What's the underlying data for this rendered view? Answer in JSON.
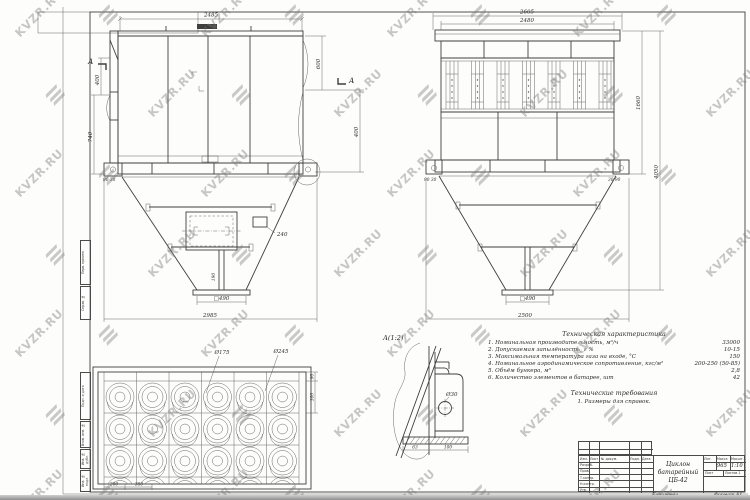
{
  "watermark": {
    "text": "KVZR.RU"
  },
  "front_view": {
    "section_label": "А",
    "dims": {
      "top_width": "2485",
      "left_upper": "400",
      "left_lower": "740",
      "right_upper": "600",
      "right_outer": "400",
      "foot_left": "90 30",
      "hatch_leader": "240",
      "center_post": "190",
      "outlet": "□490",
      "bottom_width": "2985"
    }
  },
  "side_view": {
    "dims": {
      "top_outer": "2605",
      "top_inner": "2480",
      "right_body": "1660",
      "right_total": "4050",
      "foot_left": "90 30",
      "foot_right": "30 90",
      "outlet": "□490",
      "bottom_width": "2500"
    }
  },
  "plan_view": {
    "dims": {
      "inner_dia": "Ø175",
      "outer_dia": "Ø245",
      "pitch_a": "200",
      "pitch_b": "380",
      "right_a": "90",
      "right_b": "300"
    }
  },
  "detail_view": {
    "label": "А(1:2)",
    "hole_dia": "Ø30",
    "dim_a": "63",
    "dim_b": "100"
  },
  "tech_chars": {
    "title": "Техническая характеристика",
    "items": [
      {
        "text": "1. Номинальная производительность, м³/ч",
        "value": "33000"
      },
      {
        "text": "2. Допускаемая запылённость, г %",
        "value": "10-15"
      },
      {
        "text": "3. Максимальная температура газа на входе, °С",
        "value": "150"
      },
      {
        "text": "4. Номинальное аэродинамическое сопротивление, кгс/м²",
        "value": "200-250 (50-85)"
      },
      {
        "text": "5. Объём бункера, м³",
        "value": "2,8"
      },
      {
        "text": "6. Количество элементов в батарее, шт",
        "value": "42"
      }
    ]
  },
  "tech_reqs": {
    "title": "Технические требования",
    "item": "1. Размеры для справок."
  },
  "title_block": {
    "doc_name_1": "Циклон",
    "doc_name_2": "батарейный",
    "doc_name_3": "ЦБ-42",
    "col_izm": "Изм.",
    "col_list": "Лист",
    "col_doc": "№ докум.",
    "col_sign": "Подп.",
    "col_date": "Дата",
    "row_razrab": "Разраб.",
    "row_prov": "Пров.",
    "row_tkontr": "Т.контр.",
    "row_nkontr": "Н.контр.",
    "row_utv": "Утв.",
    "lit_header": "Лит.",
    "mass_header": "Масса",
    "scale_header": "Масшт.",
    "mass_value": "965",
    "scale_value": "1:10",
    "sheet_label": "Лист",
    "sheets_label": "Листов 1",
    "below_copy": "Копировал",
    "below_format": "Формат А1"
  },
  "edge_stamps": {
    "s1": "Перв. примен.",
    "s2": "Справ. №",
    "s3": "Подп. и дата",
    "s4": "Взам. инв. №",
    "s5": "Инв. № дубл.",
    "s6": "Инв. № подл."
  }
}
